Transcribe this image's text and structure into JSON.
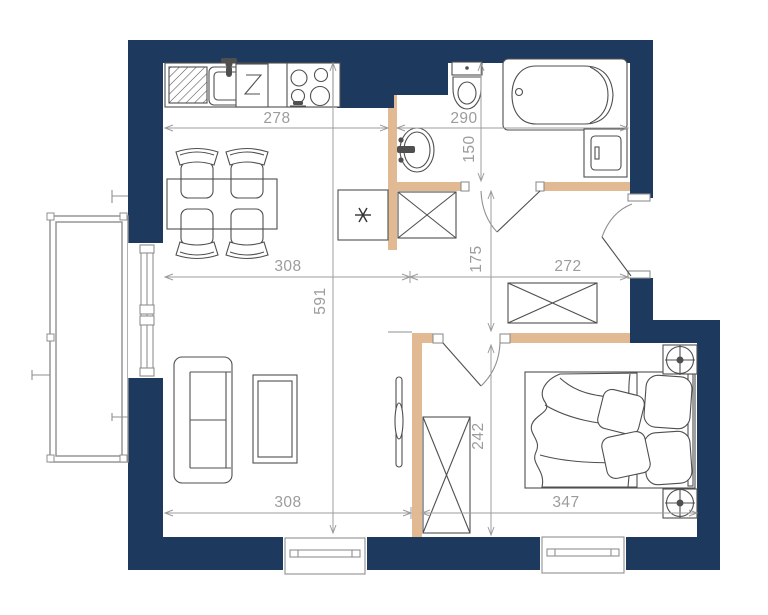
{
  "colors": {
    "wall": "#1e395e",
    "partition": "#e1b992",
    "line": "#4f4f4f",
    "dim": "#9c9c9c",
    "balcony": "#8f8f8f"
  },
  "dimensions": {
    "kitchen_width": "278",
    "bathroom_width": "290",
    "bathroom_depth": "150",
    "living_width_top": "308",
    "hall_width": "272",
    "apartment_depth": "591",
    "hall_depth": "175",
    "bedroom_depth": "242",
    "living_width_bottom": "308",
    "bedroom_width": "347"
  }
}
